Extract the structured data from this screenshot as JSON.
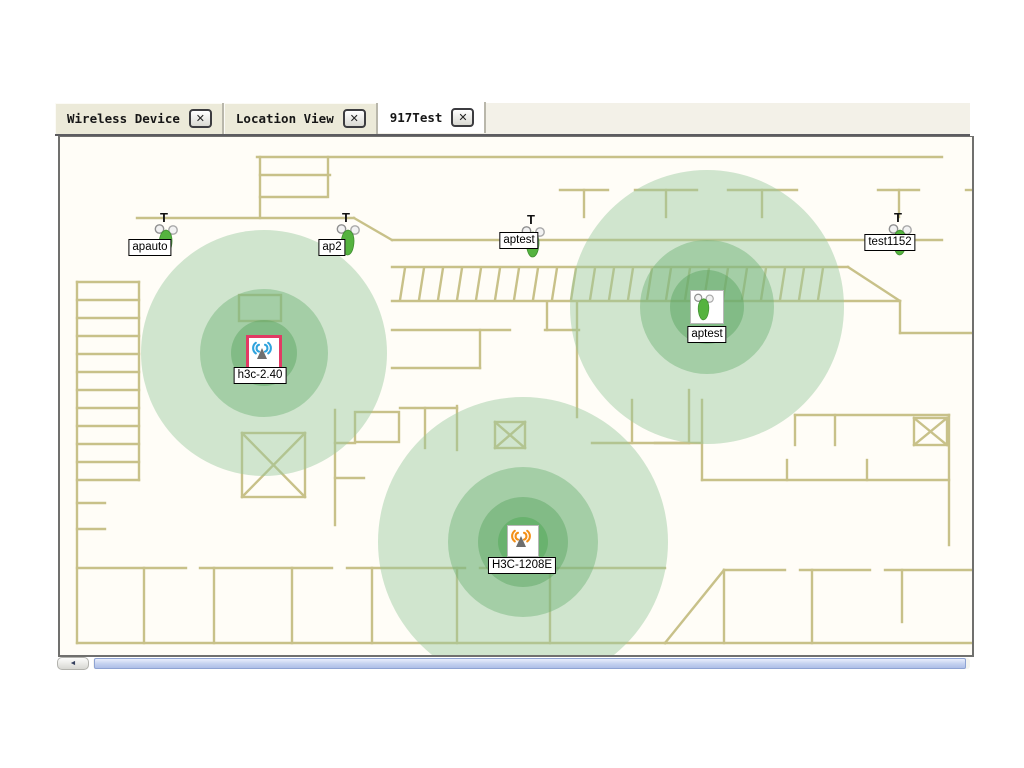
{
  "tab_bar": {
    "tabs": [
      {
        "label": "Wireless Device",
        "active": false
      },
      {
        "label": "Location View",
        "active": false
      },
      {
        "label": "917Test",
        "active": true
      }
    ],
    "close_glyph": "✕"
  },
  "map": {
    "devices": [
      {
        "id": "apauto",
        "label": "apauto",
        "kind": "tower",
        "t_mark": "T",
        "x": 91,
        "y": 84,
        "label_dx": -1,
        "label_dy": 18
      },
      {
        "id": "ap2",
        "label": "ap2",
        "kind": "tower",
        "t_mark": "T",
        "x": 273,
        "y": 84,
        "label_dx": -1,
        "label_dy": 18
      },
      {
        "id": "aptest-1",
        "label": "aptest",
        "kind": "tower",
        "t_mark": "T",
        "x": 458,
        "y": 86,
        "label_dx": 1,
        "label_dy": 9
      },
      {
        "id": "test1152",
        "label": "test1152",
        "kind": "tower",
        "t_mark": "T",
        "x": 825,
        "y": 84,
        "label_dx": 5,
        "label_dy": 13
      },
      {
        "id": "h3c-2.40",
        "label": "h3c-2.40",
        "kind": "wave",
        "wave_color": "#2fa3dd",
        "frame_color": "#e23a64",
        "frame_width": 3,
        "x": 204,
        "y": 216,
        "label_dx": -4,
        "label_dy": 14
      },
      {
        "id": "aptest-2",
        "label": "aptest",
        "kind": "tower-box",
        "frame_color": "#b8b8b8",
        "frame_width": 1,
        "x": 647,
        "y": 170,
        "label_dx": 0,
        "label_dy": 19
      },
      {
        "id": "H3C-1208E",
        "label": "H3C-1208E",
        "kind": "wave",
        "wave_color": "#f39018",
        "frame_color": "#b8b8b8",
        "frame_width": 1,
        "x": 463,
        "y": 404,
        "label_dx": -1,
        "label_dy": 16
      }
    ],
    "coverage": [
      {
        "device": "h3c-2.40",
        "cx": 204,
        "cy": 216,
        "radii": [
          123,
          64,
          33,
          18
        ]
      },
      {
        "device": "aptest-2",
        "cx": 647,
        "cy": 170,
        "radii": [
          137,
          67,
          37,
          16
        ]
      },
      {
        "device": "H3C-1208E",
        "cx": 463,
        "cy": 405,
        "radii": [
          145,
          75,
          45,
          25
        ]
      }
    ],
    "ring_colors": [
      "rgba(150,199,155,0.45)",
      "rgba(110,178,118,0.45)",
      "rgba(88,164,96,0.45)",
      "rgba(80,170,85,0.5)"
    ],
    "wall_color": "#c8c189"
  },
  "scrollbar": {
    "glyph": "◄"
  }
}
